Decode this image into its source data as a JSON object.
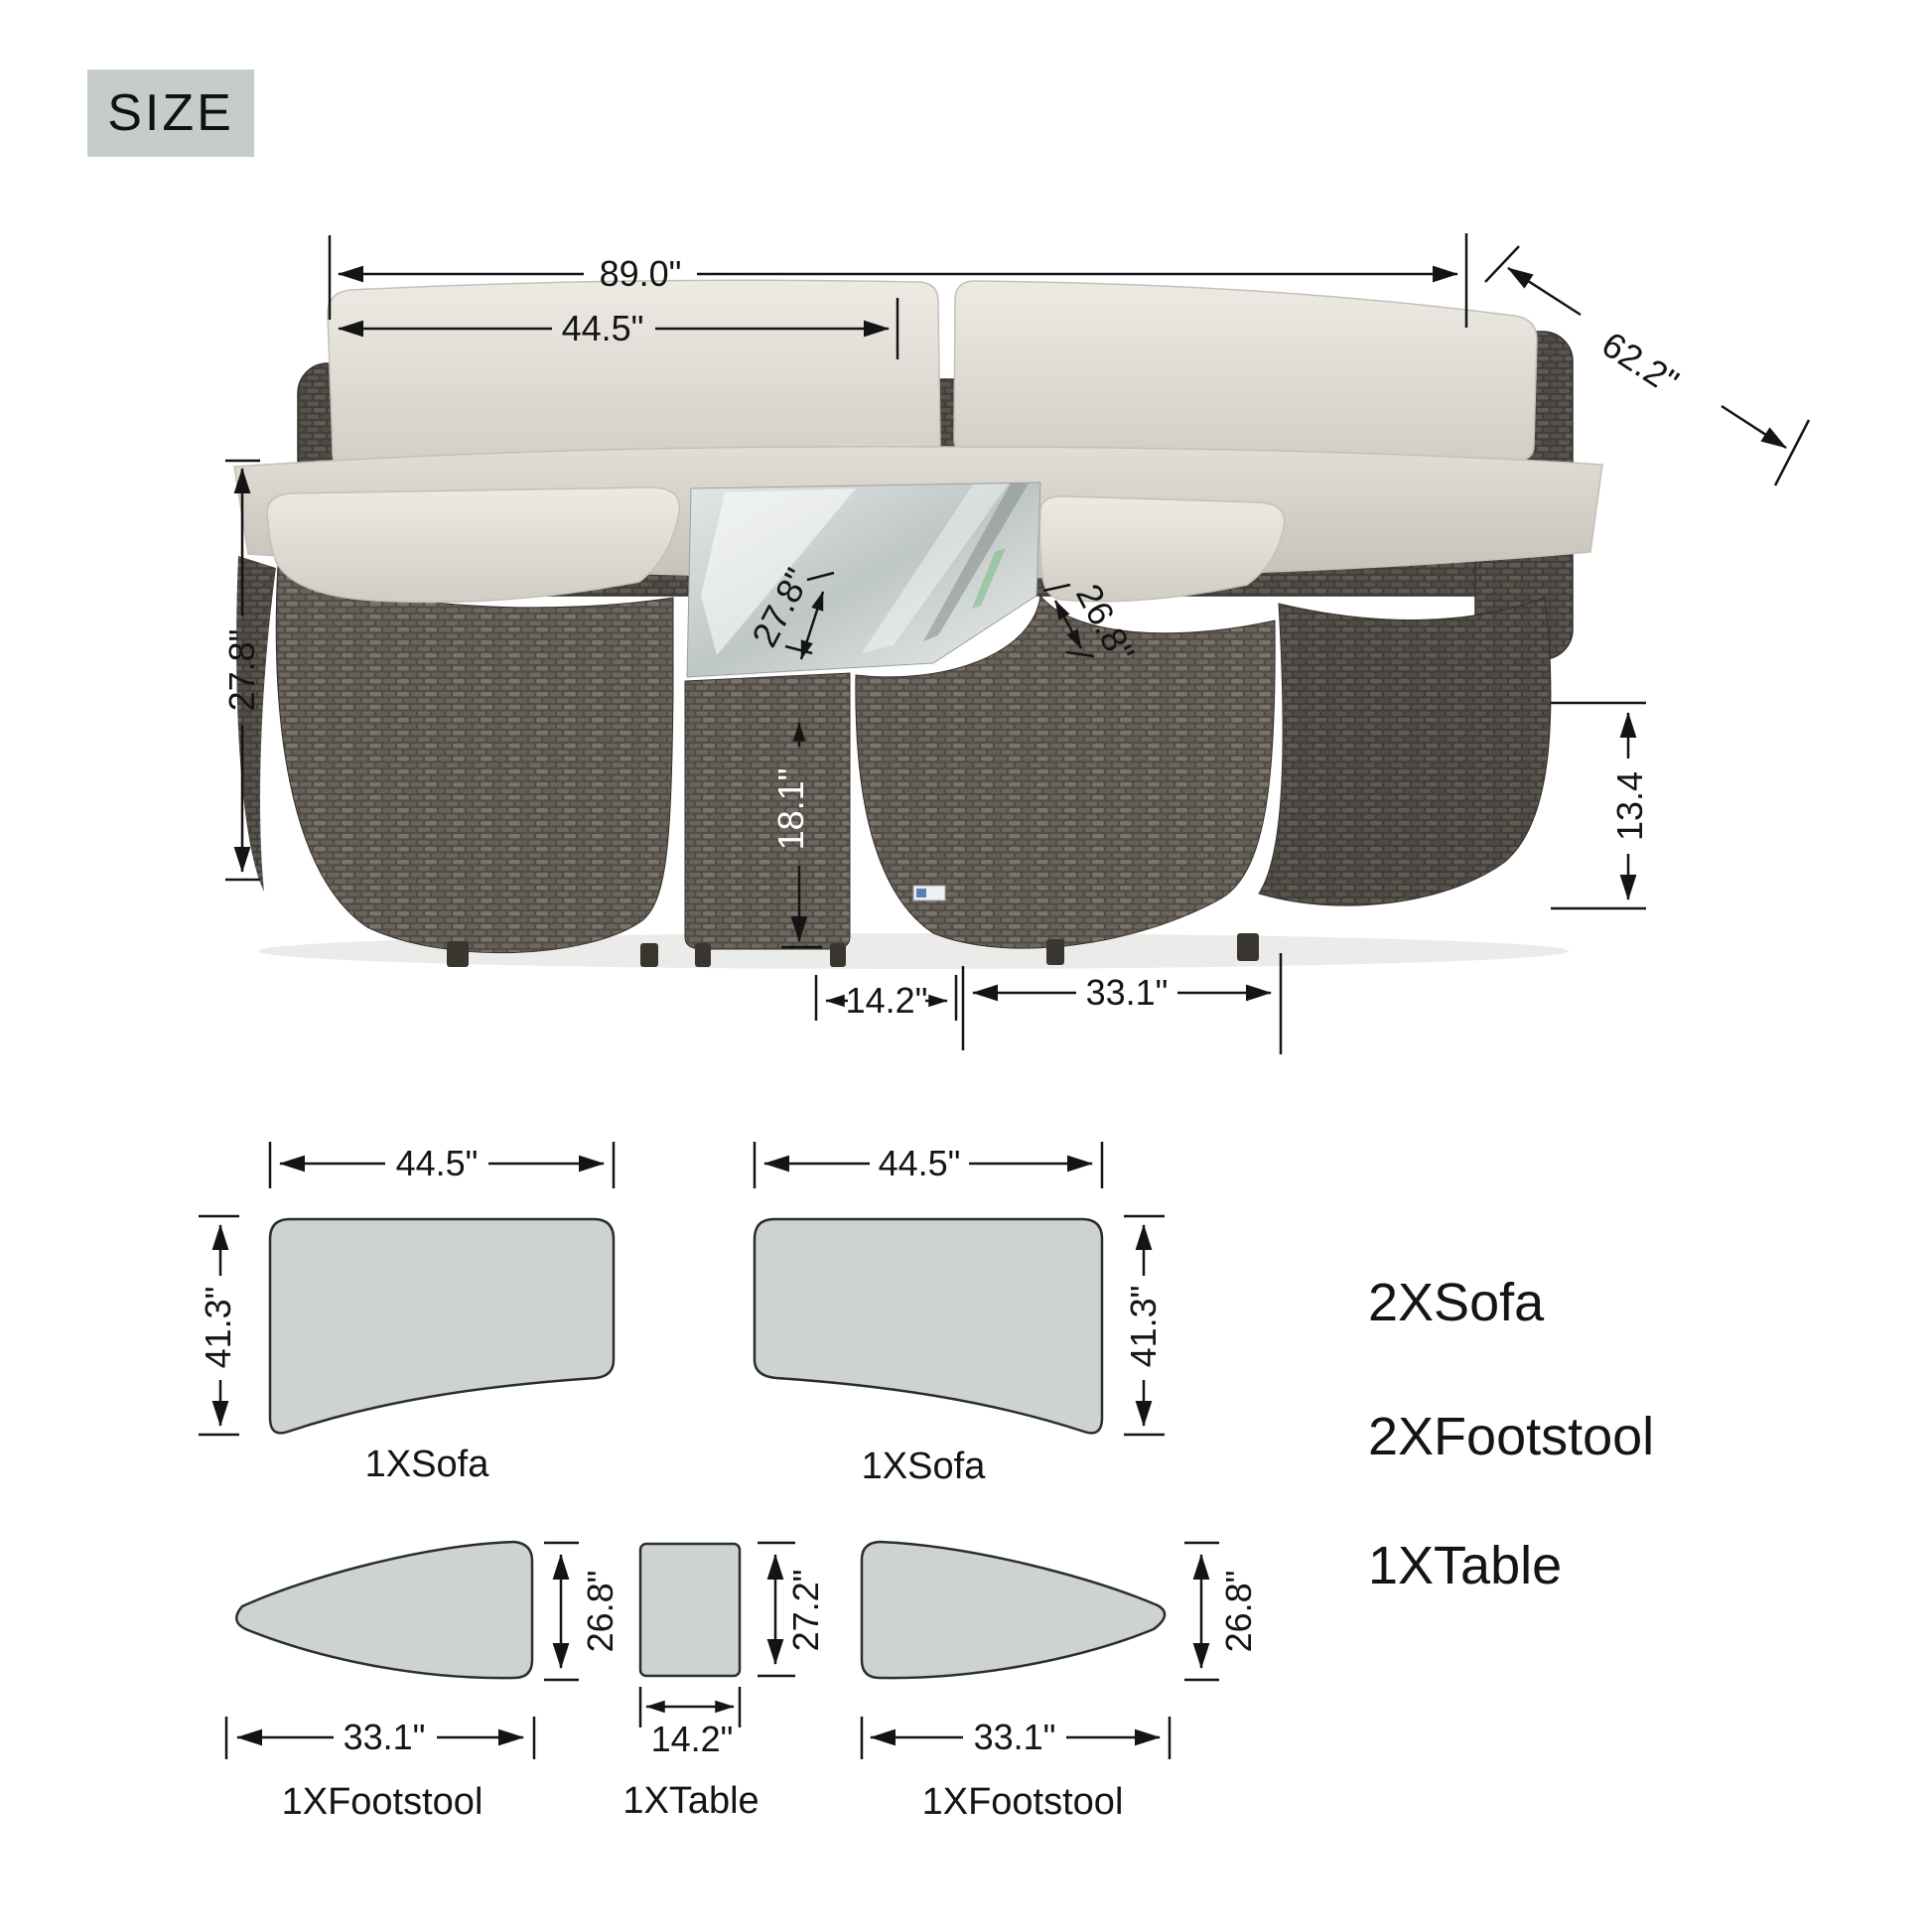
{
  "title_badge": {
    "label": "SIZE"
  },
  "photo_dims": {
    "overall_width": "89.0\"",
    "half_width": "44.5\"",
    "diagonal_depth": "62.2\"",
    "back_height": "27.8\"",
    "left_cushion_depth": "27.8\"",
    "right_cushion_depth": "26.8\"",
    "table_height": "18.1\"",
    "footstool_height": "13.4",
    "table_width": "14.2\"",
    "footstool_width": "33.1\""
  },
  "schematics": {
    "sofa_left": {
      "width": "44.5\"",
      "depth": "41.3\"",
      "caption": "1XSofa"
    },
    "sofa_right": {
      "width": "44.5\"",
      "depth": "41.3\"",
      "caption": "1XSofa"
    },
    "footstool_left": {
      "width": "33.1\"",
      "depth": "26.8\"",
      "caption": "1XFootstool"
    },
    "table": {
      "width": "14.2\"",
      "depth": "27.2\"",
      "caption": "1XTable"
    },
    "footstool_right": {
      "width": "33.1\"",
      "depth": "26.8\"",
      "caption": "1XFootstool"
    }
  },
  "legend": {
    "items": [
      "2XSofa",
      "2XFootstool",
      "1XTable"
    ]
  },
  "colors": {
    "badge_bg": "#c6cccc",
    "schematic_fill": "#cdd3d2",
    "line": "#141414",
    "cushion": "#e4e1da",
    "wicker": "#56514b",
    "glass": "#c9d1d0"
  }
}
